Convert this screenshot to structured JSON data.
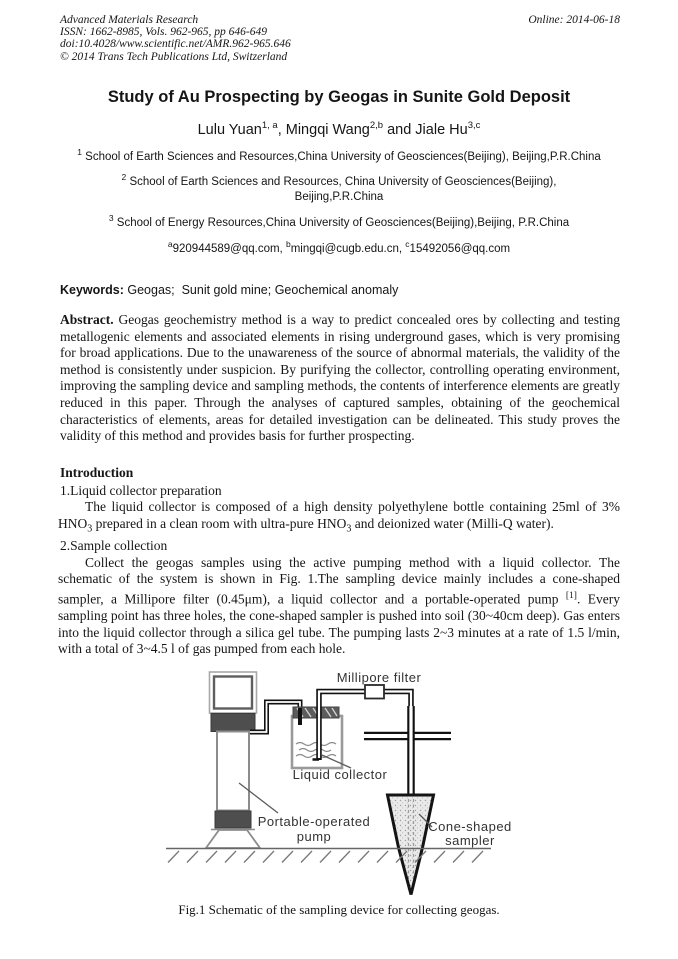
{
  "colors": {
    "page_bg": "#ffffff",
    "text": "#151515",
    "figure_line": "#111111",
    "figure_gray": "#8c8c8c"
  },
  "header": {
    "journal": "Advanced Materials Research",
    "issn_line": "ISSN: 1662-8985, Vols. 962-965, pp 646-649",
    "doi_line": "doi:10.4028/www.scientific.net/AMR.962-965.646",
    "copyright_line": "© 2014 Trans Tech Publications Ltd, Switzerland",
    "online_date": "Online: 2014-06-18"
  },
  "title": "Study of Au Prospecting by Geogas in Sunite Gold Deposit",
  "authors_rich": [
    {
      "t": "Lulu Yuan"
    },
    {
      "sup": "1, a"
    },
    {
      "t": ", Mingqi Wang"
    },
    {
      "sup": "2,b"
    },
    {
      "t": " and Jiale Hu"
    },
    {
      "sup": "3,c"
    }
  ],
  "affiliations": [
    [
      {
        "sup": "1"
      },
      {
        "t": " School of Earth Sciences and Resources,China University of Geosciences(Beijing), Beijing,P.R.China"
      }
    ],
    [
      {
        "sup": "2"
      },
      {
        "t": " School of Earth Sciences and Resources, China University of Geosciences(Beijing), Beijing,P.R.China"
      }
    ],
    [
      {
        "sup": "3"
      },
      {
        "t": " School of Energy Resources,China University of Geosciences(Beijing),Beijing, P.R.China"
      }
    ]
  ],
  "emails_rich": [
    {
      "sup": "a"
    },
    {
      "t": "920944589@qq.com, "
    },
    {
      "sup": "b"
    },
    {
      "t": "mingqi@cugb.edu.cn, "
    },
    {
      "sup": "c"
    },
    {
      "t": "15492056@qq.com"
    }
  ],
  "keywords_rich": [
    {
      "b": "Keywords:"
    },
    {
      "t": " Geogas;  Sunit gold mine; Geochemical anomaly"
    }
  ],
  "abstract_rich": [
    {
      "b": "Abstract."
    },
    {
      "t": " Geogas geochemistry method is a way to predict concealed ores by collecting and testing metallogenic elements and associated elements in rising underground gases, which is very promising for broad applications. Due to the unawareness of the source of abnormal materials, the validity of the method is consistently under suspicion. By purifying the collector, controlling operating environment, improving the sampling device and sampling methods, the contents of interference elements are greatly reduced in this paper. Through the analyses of captured samples, obtaining of the geochemical characteristics of elements, areas for detailed investigation can be delineated. This study proves the validity of this method and provides basis for further prospecting."
    }
  ],
  "introduction": {
    "heading": "Introduction",
    "sub1": "1.Liquid collector preparation",
    "p1_rich": [
      {
        "t": "The liquid collector is composed of a high density polyethylene bottle containing 25ml of 3% HNO"
      },
      {
        "sub": "3"
      },
      {
        "t": " prepared in a clean room with ultra-pure HNO"
      },
      {
        "sub": "3"
      },
      {
        "t": " and deionized water (Milli-Q water)."
      }
    ],
    "sub2": "2.Sample collection",
    "p2_rich": [
      {
        "t": "Collect the geogas samples using the active pumping method with a liquid collector. The schematic of the system is shown in Fig. 1.The sampling device mainly includes a cone-shaped sampler, a Millipore filter (0.45μm), a liquid collector and a portable-operated pump "
      },
      {
        "sup": "[1]"
      },
      {
        "t": ". Every sampling point has three holes, the cone-shaped sampler is pushed into soil (30~40cm deep). Gas enters into the liquid collector through a silica gel tube.  The pumping lasts 2~3 minutes at a rate of 1.5 l/min, with a total of 3~4.5 l of gas pumped from each hole."
      }
    ]
  },
  "figure": {
    "labels": {
      "millipore": "Millipore filter",
      "liquid": "Liquid collector",
      "pump_line1": "Portable-operated",
      "pump_line2": "pump",
      "cone_line1": "Cone-shaped",
      "cone_line2": "sampler"
    },
    "caption": "Fig.1 Schematic of the sampling device for collecting geogas."
  }
}
